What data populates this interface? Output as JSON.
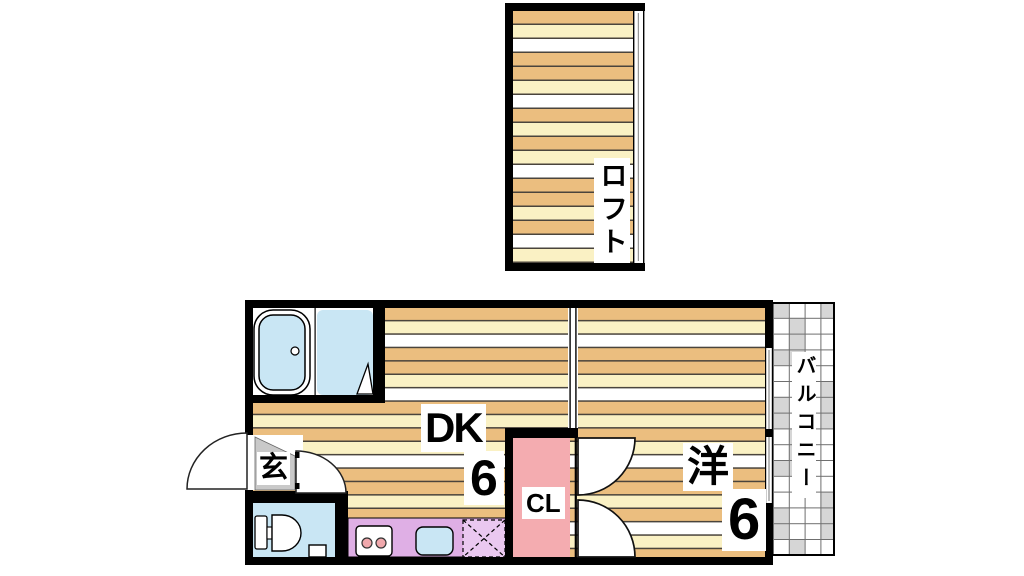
{
  "palette": {
    "wall": "#000000",
    "floor_tan": "#EBBE7F",
    "floor_cream": "#FAF1C4",
    "floor_white": "#FFFFFF",
    "floor_line": "#4A443C",
    "water_blue": "#C9E6F4",
    "kitchen_purple": "#DFAFE5",
    "fridge_purple": "#EAC8F0",
    "closet_pink": "#F4ACB0",
    "burner_pink": "#F0A8AC",
    "genkan_gray": "#C9C9C9",
    "balcony_gray": "#D6D6D6",
    "balcony_line": "#6F6F6F",
    "window_glass_line": "#8A8A8A"
  },
  "labels": {
    "loft": "ロフト",
    "balcony": "バルコニー",
    "dining_kitchen": "DK",
    "dining_kitchen_size": "6",
    "western_room": "洋",
    "western_room_size": "6",
    "closet": "CL",
    "entrance": "玄"
  },
  "fixtures": [
    "bathtub-icon",
    "bathroom-door-icon",
    "entrance-door-icon",
    "entrance-inner-door-icon",
    "toilet-icon",
    "stove-two-burner-icon",
    "kitchen-sink-icon",
    "refrigerator-space-icon",
    "closet-double-doors-icon",
    "balcony-window-icon",
    "loft-window-icon",
    "room-partition"
  ]
}
